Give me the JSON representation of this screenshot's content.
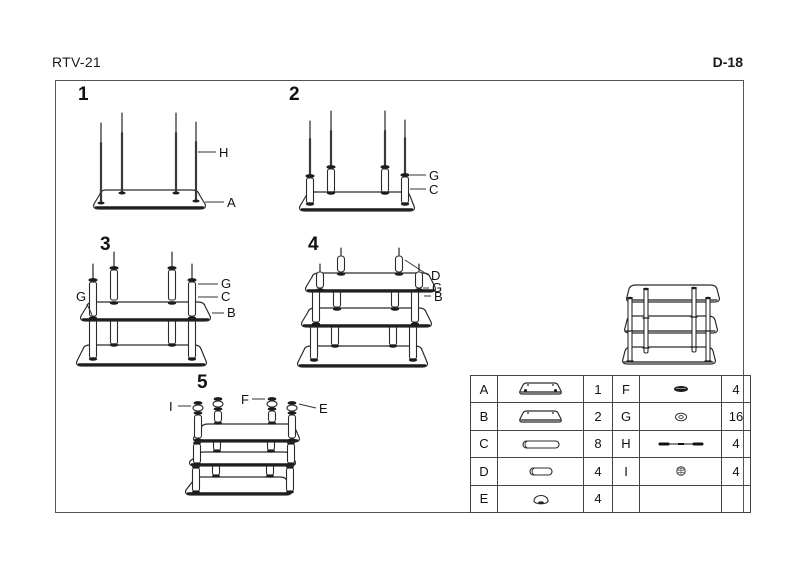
{
  "header": {
    "model": "RTV-21",
    "sheet": "D-18"
  },
  "steps": [
    {
      "number": "1",
      "labels": {
        "H": "H",
        "A": "A"
      }
    },
    {
      "number": "2",
      "labels": {
        "G": "G",
        "C": "C"
      }
    },
    {
      "number": "3",
      "labels": {
        "G_left": "G",
        "G": "G",
        "C": "C",
        "B": "B"
      }
    },
    {
      "number": "4",
      "labels": {
        "D": "D",
        "G": "G",
        "B": "B"
      }
    },
    {
      "number": "5",
      "labels": {
        "I": "I",
        "F": "F",
        "E": "E"
      }
    }
  ],
  "parts_table": {
    "rows": [
      {
        "l_part": "A",
        "l_icon": "bottom-shelf-icon",
        "l_qty": "1",
        "r_part": "F",
        "r_icon": "top-cap-disc-icon",
        "r_qty": "4"
      },
      {
        "l_part": "B",
        "l_icon": "shelf-icon",
        "l_qty": "2",
        "r_part": "G",
        "r_icon": "washer-icon",
        "r_qty": "16"
      },
      {
        "l_part": "C",
        "l_icon": "long-tube-icon",
        "l_qty": "8",
        "r_part": "H",
        "r_icon": "threaded-rod-icon",
        "r_qty": "4"
      },
      {
        "l_part": "D",
        "l_icon": "short-tube-icon",
        "l_qty": "4",
        "r_part": "I",
        "r_icon": "screw-nut-icon",
        "r_qty": "4"
      },
      {
        "l_part": "E",
        "l_icon": "dome-cap-icon",
        "l_qty": "4",
        "r_part": "",
        "r_icon": "",
        "r_qty": ""
      }
    ]
  },
  "colors": {
    "line": "#2b2b2b",
    "frame_border": "#555555",
    "background": "#ffffff",
    "fill_dark": "#1c1c1c"
  }
}
